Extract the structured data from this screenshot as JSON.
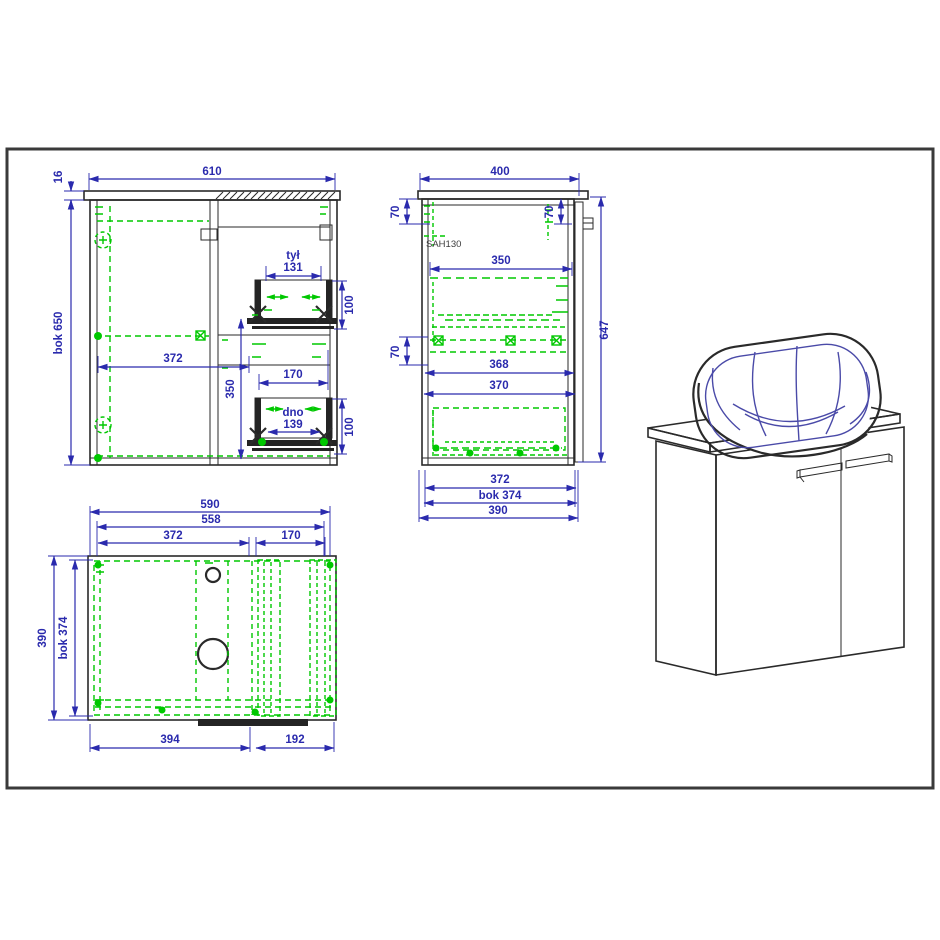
{
  "drawing": {
    "type": "furniture technical drawing - bathroom vanity cabinet with countertop basin",
    "colors": {
      "outline": "#2a2a2a",
      "dimension": "#2a2aad",
      "fitting": "#00c800",
      "basin_line": "#4a4aa8",
      "frame_border": "#3a3a3a"
    },
    "front_view": {
      "dim_610": "610",
      "dim_16": "16",
      "dim_bok_650": "bok 650",
      "dim_372": "372",
      "dim_350": "350",
      "drawer_back_label": "tył",
      "drawer_back_width": "131",
      "dim_100_top": "100",
      "dim_170": "170",
      "drawer_bottom_label": "dno",
      "drawer_bottom_width": "139",
      "dim_100_bottom": "100"
    },
    "side_view": {
      "dim_400": "400",
      "dim_70_left": "70",
      "dim_70_right": "70",
      "hinge_code": "SAH130",
      "dim_350": "350",
      "dim_647": "647",
      "dim_70_mid": "70",
      "dim_368": "368",
      "dim_370": "370",
      "dim_372": "372",
      "dim_bok_374": "bok 374",
      "dim_390": "390"
    },
    "top_view": {
      "dim_590": "590",
      "dim_558": "558",
      "dim_372": "372",
      "dim_170": "170",
      "dim_390": "390",
      "dim_bok_374": "bok 374",
      "dim_394": "394",
      "dim_192": "192"
    }
  }
}
